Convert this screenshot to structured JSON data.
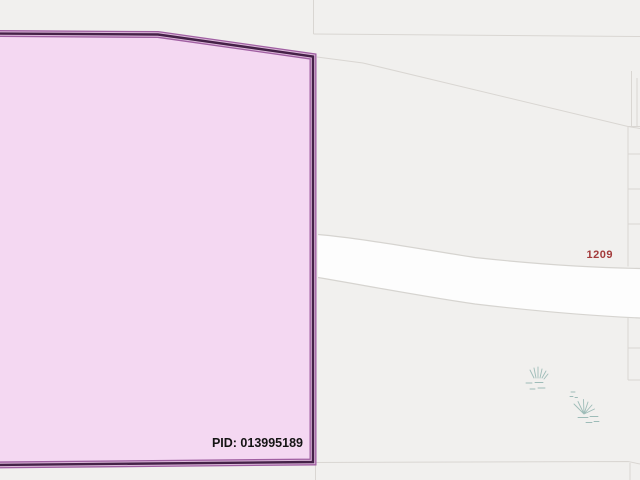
{
  "map": {
    "parcel": {
      "pid_label": "PID: 013995189"
    },
    "road_label": "1209",
    "vegetation_symbol_count": 2
  },
  "colors": {
    "background": "#f1f0ee",
    "road_fill": "#fdfdfd",
    "boundary_line": "#d9d6d2",
    "parcel_fill": "#f4d8f2",
    "parcel_border_outer": "#a05fa2",
    "parcel_border_gap": "#dcb9da",
    "parcel_border_core": "#442147",
    "pid_text": "#141414",
    "road_label_text": "#a33b3b",
    "vegetation": "#8fb3ae"
  }
}
